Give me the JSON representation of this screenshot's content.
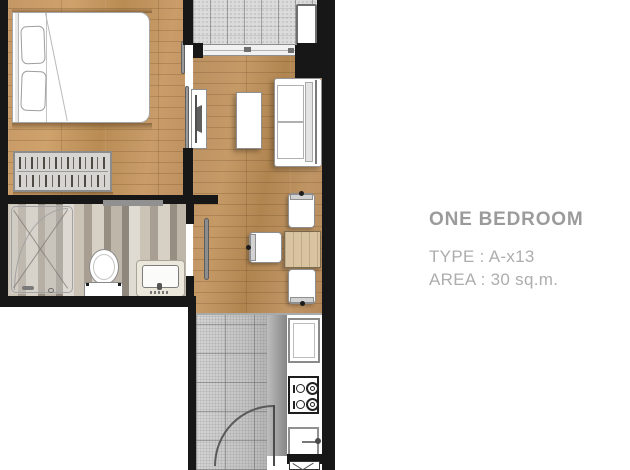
{
  "info_panel": {
    "title": "ONE BEDROOM",
    "type_line": "TYPE : A-x13",
    "area_line": "AREA : 30 sq.m.",
    "title_color": "#9b9b9b",
    "detail_color": "#adadad"
  },
  "floorplan": {
    "unit_type": "A-x13",
    "area": "30 sq.m.",
    "rooms": [
      "bedroom",
      "living area",
      "balcony",
      "bathroom",
      "dining area",
      "kitchen"
    ],
    "colors": {
      "wall": "#171717",
      "wood_floor": "#b98e5d",
      "balcony_tile": "#dbdbdb",
      "kitchen_tile": "#c9c9c9",
      "bathroom_tile": "#c6bcae",
      "dining_table_wood": "#d8c4a0",
      "furniture_white": "#ffffff"
    }
  }
}
